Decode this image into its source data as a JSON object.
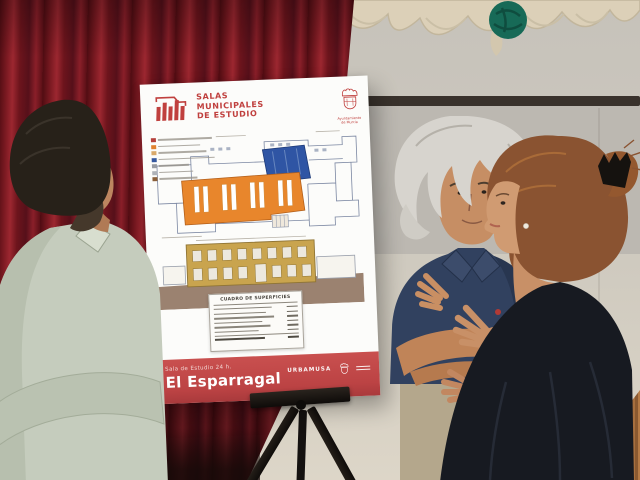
{
  "scene": {
    "setting": "room with red stage curtain, hanging cream bunting with green rosette, grey projection screen, wooden floor",
    "colors": {
      "curtain_red": "#7c1a22",
      "wall_grey": "#c8c4bc",
      "screen_bar": "#39322c",
      "bunting_cream": "#dcd0b8",
      "rosette_teal": "#176a57",
      "wood_floor": "#a76f3e",
      "easel_black": "#17130f",
      "poster_white": "#fcfcfa",
      "poster_red": "#c0403e",
      "band_red": "#c34b4d",
      "plan_orange": "#e8862c",
      "plan_blue": "#2f55a4",
      "facade_tan": "#c9a44e"
    }
  },
  "poster": {
    "header": {
      "title_line1": "SALAS",
      "title_line2": "MUNICIPALES",
      "title_line3": "DE ESTUDIO",
      "municipality_line1": "Ayuntamiento",
      "municipality_line2": "de Murcia"
    },
    "legend": {
      "items": [
        {
          "color": "#b5413c",
          "w": 54
        },
        {
          "color": "#e0812f",
          "w": 42
        },
        {
          "color": "#d9a96a",
          "w": 48
        },
        {
          "color": "#35589f",
          "w": 56
        },
        {
          "color": "#989ca3",
          "w": 30
        },
        {
          "color": "#aeb2b8",
          "w": 34
        },
        {
          "color": "#8a5f3a",
          "w": 38
        }
      ]
    },
    "plan": {
      "zones": [
        {
          "name": "study-hall",
          "color": "#e8862c"
        },
        {
          "name": "services-area",
          "color": "#2f55a4"
        },
        {
          "name": "building-facade",
          "color": "#c9a44e"
        }
      ]
    },
    "table": {
      "title": "CUADRO DE SUPERFICIES",
      "rows": [
        58,
        52,
        60,
        48,
        56,
        44,
        50
      ]
    },
    "footer": {
      "subtitle": "Sala de Estudio 24 h.",
      "title": "El Esparragal",
      "brand": "URBAMUSA"
    }
  }
}
